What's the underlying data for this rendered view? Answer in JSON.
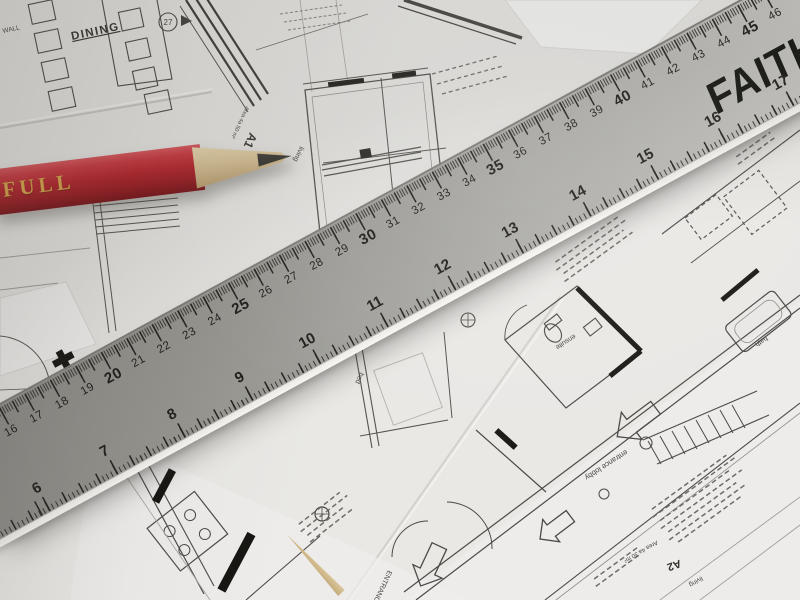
{
  "ruler": {
    "brand": "FAITHFULL",
    "cm_numbers": [
      16,
      17,
      18,
      19,
      20,
      21,
      22,
      23,
      24,
      25,
      26,
      27,
      28,
      29,
      30,
      31,
      32,
      33,
      34,
      35,
      36,
      37,
      38,
      39,
      40,
      41,
      42,
      43,
      44,
      45,
      46
    ],
    "inch_numbers": [
      6,
      7,
      8,
      9,
      10,
      11,
      12,
      13,
      14,
      15,
      16,
      17
    ],
    "colors": {
      "face_dark": "#8a8985",
      "face_light": "#cbcac6",
      "markings": "#23221e",
      "edge": "#f7f6f3"
    }
  },
  "pencil": {
    "brand": "FAITHFULL",
    "colors": {
      "body": "#b5242c",
      "brand_text": "#d9a74a",
      "wood": "#dcc69a",
      "lead": "#23221d"
    }
  },
  "blueprints": {
    "ink_color": "#4b4a46",
    "labels": {
      "dining": "DINING",
      "wall": "WALL",
      "detail_marker": "27",
      "a1": "A1",
      "area_a1": "Area 4a 50 m²",
      "living_a1": "living",
      "bed": "bed",
      "ensuite": "ensuite",
      "bath": "bath",
      "entrance_lobby": "entrance lobby",
      "entrance": "ENTRANCE",
      "a2": "A2",
      "area_a2": "Area 4a 30 m²",
      "living_a2": "living"
    }
  }
}
